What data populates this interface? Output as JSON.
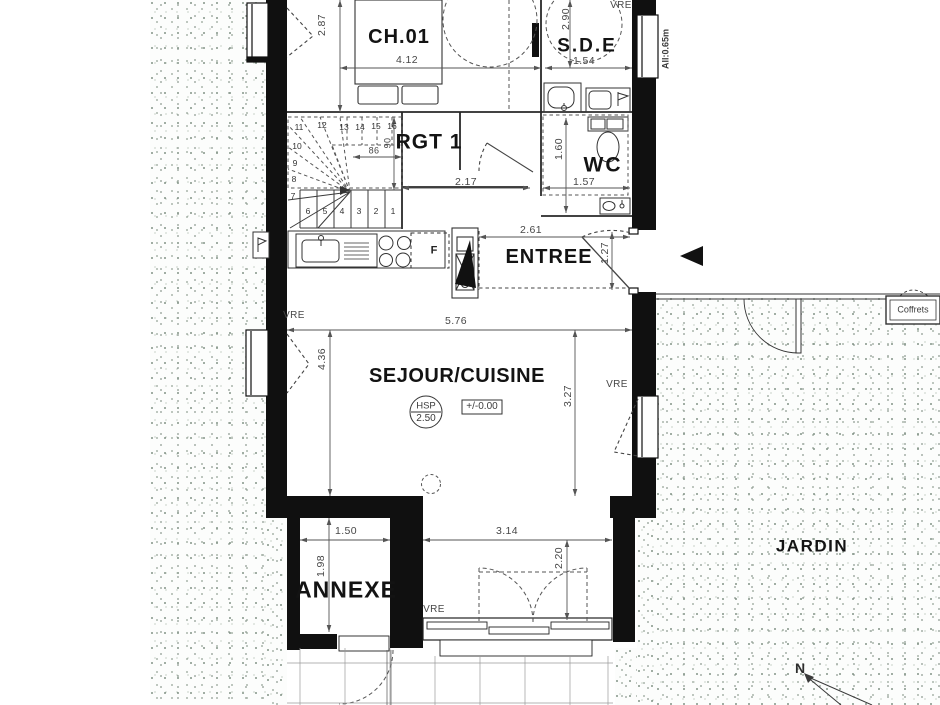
{
  "meta": {
    "type": "architectural floor plan",
    "level": "rez-de-jardin"
  },
  "colors": {
    "wall": "#101010",
    "line": "#333333",
    "dim_line": "#555555",
    "dim_text": "#474747",
    "label_text": "#131313",
    "stipple_dot": "#8a9a8e",
    "paper": "#ffffff"
  },
  "rooms": {
    "ch01": {
      "label": "CH.01"
    },
    "sde": {
      "label": "S.D.E"
    },
    "rgt1": {
      "label": "RGT 1"
    },
    "wc": {
      "label": "WC"
    },
    "entree": {
      "label": "ENTREE"
    },
    "sejour": {
      "label": "SEJOUR/CUISINE"
    },
    "annexe": {
      "label": "ANNEXE"
    },
    "jardin": {
      "label": "JARDIN"
    }
  },
  "annotations": {
    "ceiling_height": {
      "abbr": "HSP",
      "value": "2.50"
    },
    "level_mark": "+/-0.00",
    "sill_height": "All:0.65m",
    "coffrets": "Coffrets",
    "north": "N",
    "window_shutter": "VRE",
    "fridge": "F"
  },
  "dimensions": [
    {
      "t": "2.87",
      "x": 322,
      "y": 25,
      "v": 1
    },
    {
      "t": "4.12",
      "x": 407,
      "y": 60
    },
    {
      "t": "2.90",
      "x": 566,
      "y": 19,
      "v": 1
    },
    {
      "t": "1.54",
      "x": 584,
      "y": 61
    },
    {
      "t": "86",
      "x": 374,
      "y": 151,
      "s": 9
    },
    {
      "t": "90",
      "x": 388,
      "y": 143,
      "v": 1,
      "s": 9
    },
    {
      "t": "2.17",
      "x": 466,
      "y": 182
    },
    {
      "t": "1.60",
      "x": 559,
      "y": 149,
      "v": 1
    },
    {
      "t": "1.57",
      "x": 584,
      "y": 182
    },
    {
      "t": "2.61",
      "x": 531,
      "y": 230
    },
    {
      "t": "1.27",
      "x": 605,
      "y": 253,
      "v": 1
    },
    {
      "t": "5.76",
      "x": 456,
      "y": 321
    },
    {
      "t": "4.36",
      "x": 322,
      "y": 359,
      "v": 1
    },
    {
      "t": "3.27",
      "x": 568,
      "y": 396,
      "v": 1
    },
    {
      "t": "1.50",
      "x": 346,
      "y": 531
    },
    {
      "t": "1.98",
      "x": 321,
      "y": 566,
      "v": 1
    },
    {
      "t": "3.14",
      "x": 507,
      "y": 531
    },
    {
      "t": "2.20",
      "x": 559,
      "y": 558,
      "v": 1
    }
  ],
  "vre_labels": [
    {
      "x": 294,
      "y": 316
    },
    {
      "x": 617,
      "y": 385
    },
    {
      "x": 434,
      "y": 610
    },
    {
      "x": 621,
      "y": 6
    }
  ],
  "stairs": {
    "steps": [
      {
        "n": "1",
        "x": 393,
        "y": 211
      },
      {
        "n": "2",
        "x": 376,
        "y": 211
      },
      {
        "n": "3",
        "x": 359,
        "y": 211
      },
      {
        "n": "4",
        "x": 342,
        "y": 211
      },
      {
        "n": "5",
        "x": 325,
        "y": 211
      },
      {
        "n": "6",
        "x": 308,
        "y": 211
      },
      {
        "n": "7",
        "x": 293,
        "y": 196
      },
      {
        "n": "8",
        "x": 294,
        "y": 179
      },
      {
        "n": "9",
        "x": 295,
        "y": 163
      },
      {
        "n": "10",
        "x": 297,
        "y": 146
      },
      {
        "n": "11",
        "x": 299,
        "y": 127
      },
      {
        "n": "12",
        "x": 322,
        "y": 125
      },
      {
        "n": "13",
        "x": 344,
        "y": 127
      },
      {
        "n": "14",
        "x": 360,
        "y": 127
      },
      {
        "n": "15",
        "x": 376,
        "y": 126
      },
      {
        "n": "16",
        "x": 392,
        "y": 126
      }
    ]
  }
}
